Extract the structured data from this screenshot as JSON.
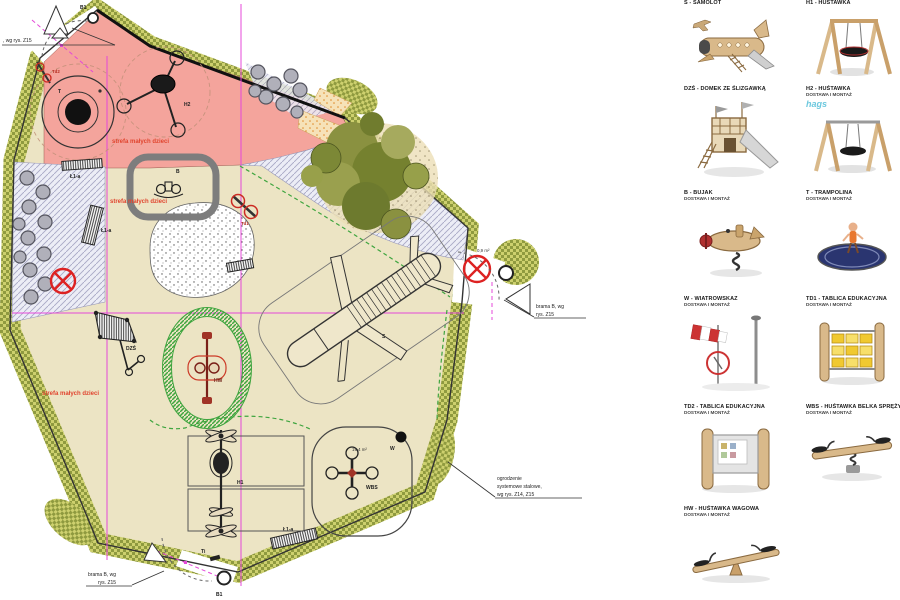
{
  "plan": {
    "texts": {
      "gate_top_note": ", wg rys. Z15",
      "gate_right_line1": "brama B, wg",
      "gate_right_line2": "rys. Z15",
      "gate_bottom_line1": "brama B, wg",
      "gate_bottom_line2": "rys. Z15",
      "fence_line1": "ogrodzenie",
      "fence_line2": "systemowe stalowe,",
      "fence_line3": "wg rys. Z14, Z15",
      "zone_small_kids": "strefa małych dzieci",
      "area_wbs": "19,4 m²",
      "area_gate": "0,9 m²",
      "point_b1": "B1"
    },
    "labels": {
      "trampoline": "T",
      "swing2": "H2",
      "rocker": "B",
      "board1": "Td1",
      "board2": "Td2",
      "house_slide": "DZŚ",
      "seesaw": "HW",
      "swing1": "H1",
      "spring_beam": "WBS",
      "plane": "S",
      "windsock": "W",
      "info_board": "Ti",
      "bench": "Ł1-a"
    }
  },
  "legend": {
    "items": [
      {
        "label": "S - SAMOLOT",
        "sub": ""
      },
      {
        "label": "H1 - HUŚTAWKA",
        "sub": ""
      },
      {
        "label": "DZŚ - DOMEK ZE ŚLIZGAWKĄ",
        "sub": ""
      },
      {
        "label": "H2 - HUŚTAWKA",
        "sub": "DOSTAWA I MONTAŻ",
        "watermark": "hags"
      },
      {
        "label": "B - BUJAK",
        "sub": "DOSTAWA I MONTAŻ"
      },
      {
        "label": "T - TRAMPOLINA",
        "sub": "DOSTAWA I MONTAŻ"
      },
      {
        "label": "W - WIATROWSKAZ",
        "sub": "DOSTAWA I MONTAŻ"
      },
      {
        "label": "TD1 - TABLICA EDUKACYJNA",
        "sub": "DOSTAWA I MONTAŻ"
      },
      {
        "label": "TD2 - TABLICA EDUKACYJNA",
        "sub": "DOSTAWA I MONTAŻ"
      },
      {
        "label": "WBS - HUŚTAWKA BELKA SPRĘŻYNOWA",
        "sub": "DOSTAWA I MONTAŻ"
      },
      {
        "label": "HW - HUŚTAWKA WAGOWA",
        "sub": "DOSTAWA I MONTAŻ"
      }
    ]
  },
  "colors": {
    "surface_beige": "#ece4c4",
    "zone_pink": "#f4a49c",
    "fence_olive": "#cdd06e",
    "fence_olive_dark": "#8f9a3f",
    "construction_magenta": "#e448d8",
    "safety_green": "#3fa53f",
    "alert_red": "#dd2222"
  }
}
